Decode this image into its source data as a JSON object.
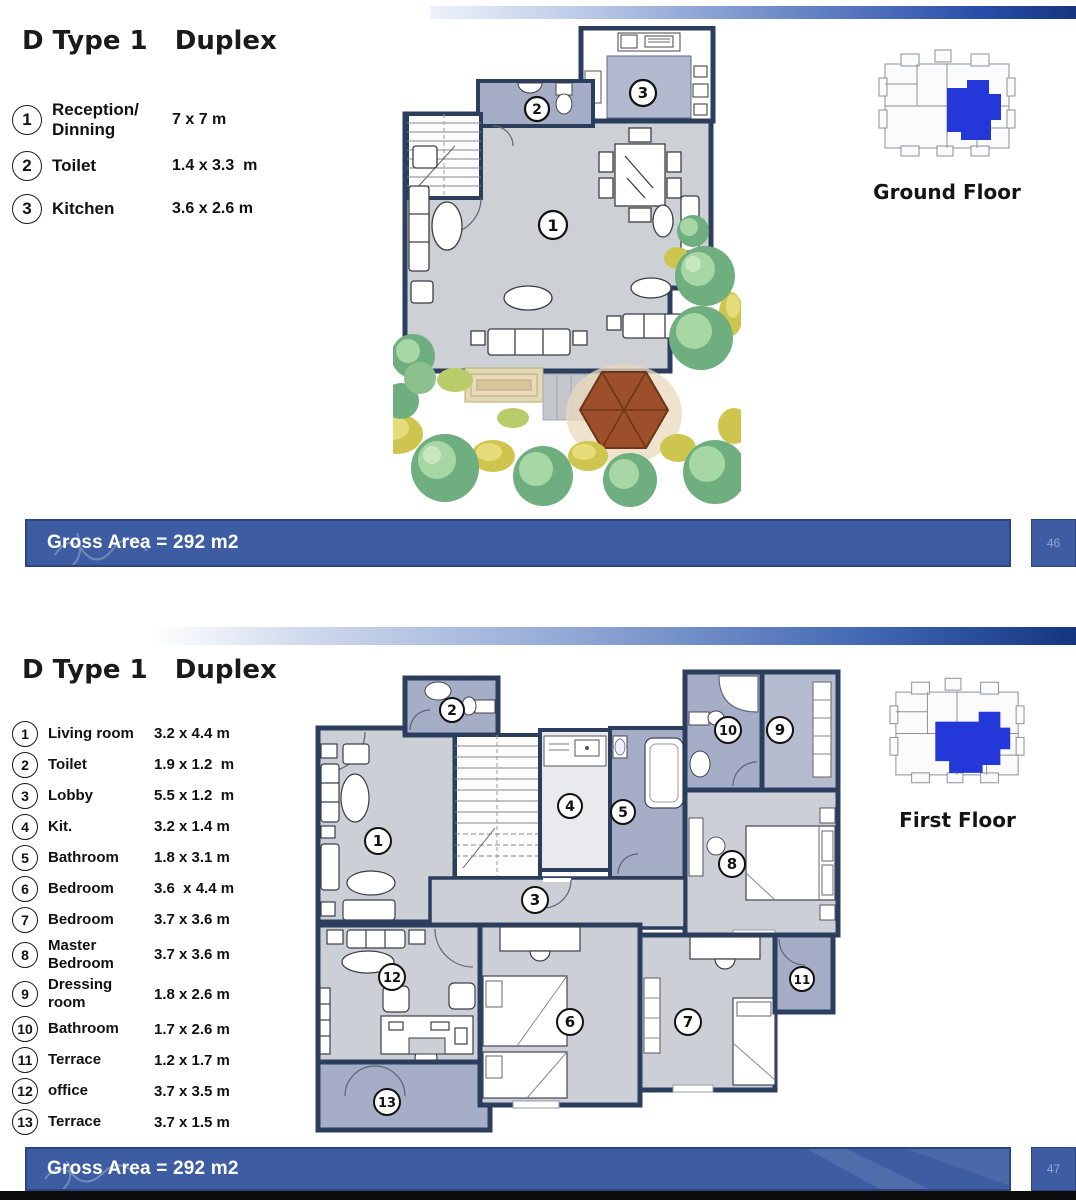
{
  "section1": {
    "title": "D Type 1   Duplex",
    "floor_label": "Ground Floor",
    "gross_area": "Gross Area = 292 m2",
    "page_number": "46",
    "legend": [
      {
        "num": "1",
        "label": "Reception/ Dinning",
        "dim": "7 x 7 m"
      },
      {
        "num": "2",
        "label": "Toilet",
        "dim": "1.4 x 3.3  m"
      },
      {
        "num": "3",
        "label": "Kitchen",
        "dim": "3.6 x 2.6 m"
      }
    ]
  },
  "section2": {
    "title": "D Type 1   Duplex",
    "floor_label": "First Floor",
    "gross_area": "Gross Area = 292 m2",
    "page_number": "47",
    "legend": [
      {
        "num": "1",
        "label": "Living room",
        "dim": "3.2 x 4.4 m"
      },
      {
        "num": "2",
        "label": "Toilet",
        "dim": "1.9 x 1.2  m"
      },
      {
        "num": "3",
        "label": "Lobby",
        "dim": "5.5 x 1.2  m"
      },
      {
        "num": "4",
        "label": "Kit.",
        "dim": "3.2 x 1.4 m"
      },
      {
        "num": "5",
        "label": "Bathroom",
        "dim": "1.8 x 3.1 m"
      },
      {
        "num": "6",
        "label": "Bedroom",
        "dim": "3.6  x 4.4 m"
      },
      {
        "num": "7",
        "label": "Bedroom",
        "dim": "3.7 x 3.6 m"
      },
      {
        "num": "8",
        "label": "Master Bedroom",
        "dim": "3.7 x 3.6 m"
      },
      {
        "num": "9",
        "label": "Dressing room",
        "dim": "1.8 x 2.6 m"
      },
      {
        "num": "10",
        "label": "Bathroom",
        "dim": "1.7 x 2.6 m"
      },
      {
        "num": "11",
        "label": "Terrace",
        "dim": "1.2 x 1.7 m"
      },
      {
        "num": "12",
        "label": "office",
        "dim": "3.7 x 3.5 m"
      },
      {
        "num": "13",
        "label": "Terrace",
        "dim": "3.7 x 1.5 m"
      }
    ]
  },
  "colors": {
    "wall": "#2c3e5e",
    "room_gray": "#cdd0d5",
    "room_blue": "#a6adc6",
    "bar_blue": "#3e5ca2",
    "minimap_highlight": "#2437d8",
    "tree_green": "#6fae7e",
    "bush_yellow": "#cec54f",
    "gazebo_brown": "#9c4f2a"
  }
}
